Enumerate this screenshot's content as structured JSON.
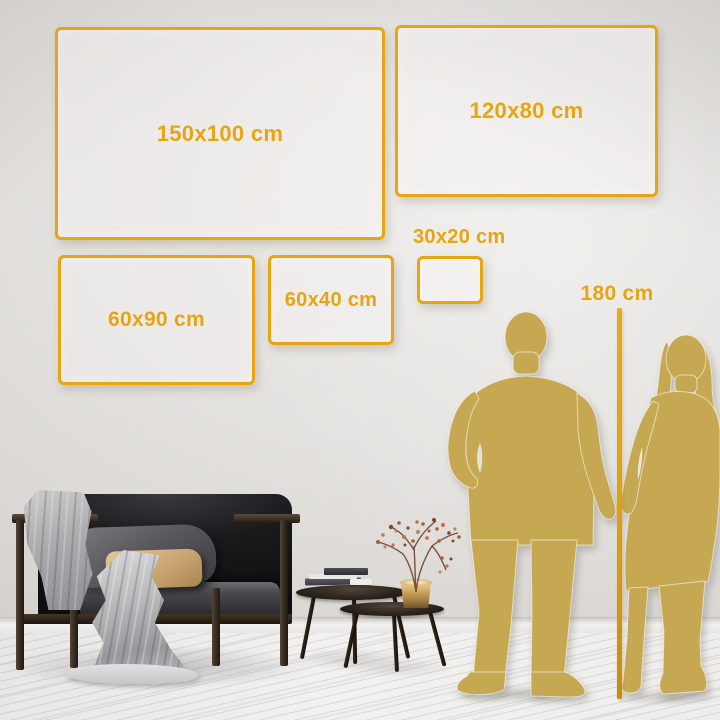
{
  "colors": {
    "accent": "#E6A511",
    "silhouette": "#C7A852",
    "wall": "#E2E0DD",
    "floor": "#F0EFEE"
  },
  "size_labels": {
    "frame_150x100": "150x100 cm",
    "frame_120x80": "120x80 cm",
    "frame_60x90": "60x90 cm",
    "frame_60x40": "60x40 cm",
    "frame_30x20": "30x20 cm"
  },
  "height_reference": {
    "label": "180 cm"
  }
}
